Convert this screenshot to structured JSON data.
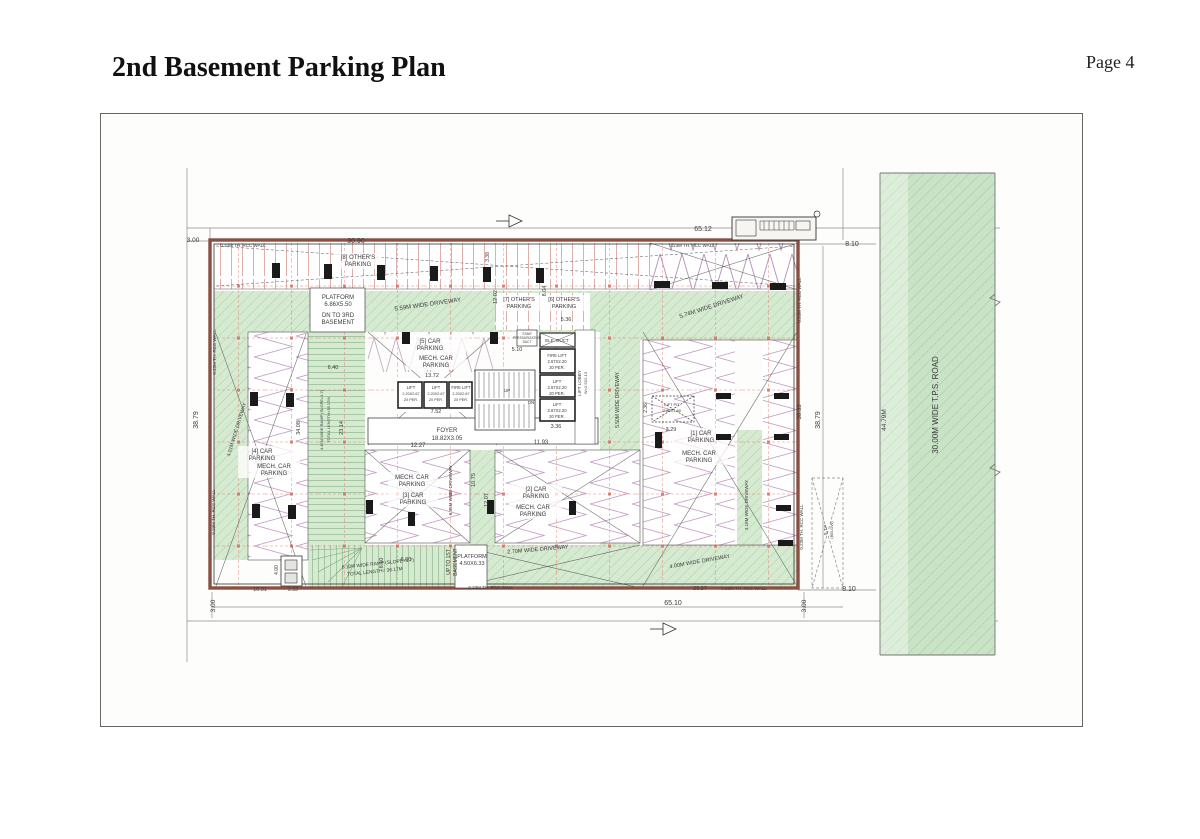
{
  "page": {
    "title": "2nd Basement Parking Plan",
    "page_number": "Page 4"
  },
  "plan": {
    "colors": {
      "wall": "#8a4f43",
      "green": "#d5ead1",
      "road_green": "#c9e3c6",
      "grid_red": "#e0796a",
      "zigzag": "#b48fb5",
      "stall_line": "#d89b93",
      "text": "#3b3b3b"
    },
    "labels": [
      {
        "t": "65.12",
        "x": 703,
        "y": 231,
        "s": 7
      },
      {
        "t": "30.90",
        "x": 356,
        "y": 243,
        "s": 7
      },
      {
        "t": "3.00",
        "x": 193,
        "y": 242,
        "s": 6.5
      },
      {
        "t": "8.10",
        "x": 852,
        "y": 246,
        "s": 7
      },
      {
        "t": "8.10",
        "x": 849,
        "y": 591,
        "s": 7
      },
      {
        "t": "65.10",
        "x": 673,
        "y": 605,
        "s": 7
      },
      {
        "t": "3.00",
        "x": 215,
        "y": 606,
        "s": 6.5,
        "r": -90
      },
      {
        "t": "3.00",
        "x": 806,
        "y": 606,
        "s": 6.5,
        "r": -90
      },
      {
        "t": "38.79",
        "x": 198,
        "y": 420,
        "s": 7,
        "r": -90
      },
      {
        "t": "38.79",
        "x": 820,
        "y": 420,
        "s": 7,
        "r": -90
      },
      {
        "t": "38.33",
        "x": 801,
        "y": 412,
        "s": 6,
        "r": -90
      },
      {
        "t": "44.79M",
        "x": 886,
        "y": 420,
        "s": 6.5,
        "r": -90
      },
      {
        "t": "30.00M WIDE T.P.S. ROAD",
        "x": 938,
        "y": 405,
        "s": 8,
        "r": -90
      },
      {
        "t": "0.23M TH. RCC WALL",
        "x": 243,
        "y": 247,
        "s": 4.5
      },
      {
        "t": "0.23M TH. RCC WALL",
        "x": 692,
        "y": 247,
        "s": 4.5
      },
      {
        "t": "0.23M TH. RCC WALL",
        "x": 216,
        "y": 352,
        "s": 4.5,
        "r": -90
      },
      {
        "t": "0.23M TH. RCC WALL",
        "x": 215,
        "y": 512,
        "s": 4.5,
        "r": -90
      },
      {
        "t": "0.23M TH. RCC WALL",
        "x": 801,
        "y": 300,
        "s": 4.5,
        "r": -90
      },
      {
        "t": "0.23M TH. RCC WALL",
        "x": 803,
        "y": 527,
        "s": 4.5,
        "r": -90
      },
      {
        "t": "0.23M TH. RCC WALL",
        "x": 491,
        "y": 589,
        "s": 4.5
      },
      {
        "t": "0.23M TH. RCC WALL",
        "x": 744,
        "y": 590,
        "s": 4.5
      },
      {
        "t": "[8] OTHER'S",
        "x": 358,
        "y": 259,
        "s": 6
      },
      {
        "t": "PARKING",
        "x": 358,
        "y": 266,
        "s": 6
      },
      {
        "t": "3.38",
        "x": 489,
        "y": 257,
        "s": 5,
        "r": -90
      },
      {
        "t": "12.02",
        "x": 497,
        "y": 297,
        "s": 5.5,
        "r": -90
      },
      {
        "t": "8.04",
        "x": 546,
        "y": 291,
        "s": 5.5,
        "r": -90
      },
      {
        "t": "PLATFORM",
        "x": 338,
        "y": 299,
        "s": 6
      },
      {
        "t": "6.86X5.50",
        "x": 338,
        "y": 306,
        "s": 6
      },
      {
        "t": "DN TO 3RD",
        "x": 338,
        "y": 317,
        "s": 6
      },
      {
        "t": "BASEMENT",
        "x": 338,
        "y": 324,
        "s": 6
      },
      {
        "t": "5.59M WIDE DRIVEWAY",
        "x": 428,
        "y": 306,
        "s": 6,
        "r": -8
      },
      {
        "t": "5.74M WIDE DRIVEWAY",
        "x": 712,
        "y": 308,
        "s": 6,
        "r": -18
      },
      {
        "t": "4.01M WIDE DRIVEWAY",
        "x": 238,
        "y": 430,
        "s": 5,
        "r": -73
      },
      {
        "t": "[7] OTHER'S",
        "x": 519,
        "y": 301,
        "s": 5.5
      },
      {
        "t": "PARKING",
        "x": 519,
        "y": 308,
        "s": 5.5
      },
      {
        "t": "[6] OTHER'S",
        "x": 564,
        "y": 301,
        "s": 5.5
      },
      {
        "t": "PARKING",
        "x": 564,
        "y": 308,
        "s": 5.5
      },
      {
        "t": "5.36",
        "x": 566,
        "y": 321,
        "s": 5.5
      },
      {
        "t": "STAIR",
        "x": 527,
        "y": 335,
        "s": 3.2
      },
      {
        "t": "PRESSURIZATION",
        "x": 527,
        "y": 339,
        "s": 3.2
      },
      {
        "t": "DUCT",
        "x": 527,
        "y": 343,
        "s": 3.2
      },
      {
        "t": "ELE. DUCT",
        "x": 557,
        "y": 342,
        "s": 4.5
      },
      {
        "t": "5.10",
        "x": 517,
        "y": 351,
        "s": 5.5
      },
      {
        "t": "[5] CAR",
        "x": 430,
        "y": 343,
        "s": 6
      },
      {
        "t": "PARKING",
        "x": 430,
        "y": 350,
        "s": 6
      },
      {
        "t": "MECH. CAR",
        "x": 436,
        "y": 360,
        "s": 6
      },
      {
        "t": "PARKING",
        "x": 436,
        "y": 367,
        "s": 6
      },
      {
        "t": "6.40",
        "x": 333,
        "y": 369,
        "s": 5.5
      },
      {
        "t": "13.72",
        "x": 432,
        "y": 377,
        "s": 5.5
      },
      {
        "t": "FIRE LIFT",
        "x": 557,
        "y": 357,
        "s": 4.2
      },
      {
        "t": "2.67X2.20",
        "x": 557,
        "y": 363,
        "s": 4.2
      },
      {
        "t": "20 PER.",
        "x": 557,
        "y": 369,
        "s": 4.2
      },
      {
        "t": "LIFT",
        "x": 557,
        "y": 383,
        "s": 4.2
      },
      {
        "t": "2.67X2.20",
        "x": 557,
        "y": 389,
        "s": 4.2
      },
      {
        "t": "20 PER.",
        "x": 557,
        "y": 395,
        "s": 4.2
      },
      {
        "t": "LIFT",
        "x": 557,
        "y": 406,
        "s": 4.2
      },
      {
        "t": "2.67X2.20",
        "x": 557,
        "y": 412,
        "s": 4.2
      },
      {
        "t": "20 PER.",
        "x": 557,
        "y": 418,
        "s": 4.2
      },
      {
        "t": "LIFT LOBBY",
        "x": 581,
        "y": 383,
        "s": 4.5,
        "r": -90
      },
      {
        "t": "W=2.5X2.13",
        "x": 587,
        "y": 383,
        "s": 4,
        "r": -90
      },
      {
        "t": "3.36",
        "x": 556,
        "y": 428,
        "s": 5.5
      },
      {
        "t": "LIFT",
        "x": 411,
        "y": 389,
        "s": 4.2
      },
      {
        "t": "2.20X2.67",
        "x": 411,
        "y": 395,
        "s": 3.8
      },
      {
        "t": "20 PER.",
        "x": 411,
        "y": 401,
        "s": 3.8
      },
      {
        "t": "LIFT",
        "x": 436,
        "y": 389,
        "s": 4.2
      },
      {
        "t": "2.20X2.67",
        "x": 436,
        "y": 395,
        "s": 3.8
      },
      {
        "t": "20 PER.",
        "x": 436,
        "y": 401,
        "s": 3.8
      },
      {
        "t": "FIRE LIFT",
        "x": 461,
        "y": 389,
        "s": 4.2
      },
      {
        "t": "2.20X2.67",
        "x": 461,
        "y": 395,
        "s": 3.8
      },
      {
        "t": "20 PER.",
        "x": 461,
        "y": 401,
        "s": 3.8
      },
      {
        "t": "7.52",
        "x": 436,
        "y": 413,
        "s": 5.5
      },
      {
        "t": "UP",
        "x": 507,
        "y": 392,
        "s": 4.5
      },
      {
        "t": "DN",
        "x": 531,
        "y": 404,
        "s": 4.5
      },
      {
        "t": "FOYER",
        "x": 447,
        "y": 432,
        "s": 6
      },
      {
        "t": "18.82X3.05",
        "x": 447,
        "y": 440,
        "s": 6
      },
      {
        "t": "12.27",
        "x": 418,
        "y": 447,
        "s": 6
      },
      {
        "t": "11.93",
        "x": 541,
        "y": 444,
        "s": 6
      },
      {
        "t": "34.08",
        "x": 300,
        "y": 428,
        "s": 5.5,
        "r": -90
      },
      {
        "t": "4.49M WIDE RAMP (SLOPE=1:7)",
        "x": 323,
        "y": 420,
        "s": 4,
        "r": -90
      },
      {
        "t": "TOTAL LENGTH=35.17M",
        "x": 330,
        "y": 420,
        "s": 4,
        "r": -90
      },
      {
        "t": "23.14",
        "x": 343,
        "y": 428,
        "s": 5.5,
        "r": -90
      },
      {
        "t": "[4] CAR",
        "x": 262,
        "y": 453,
        "s": 6
      },
      {
        "t": "PARKING",
        "x": 262,
        "y": 460,
        "s": 6
      },
      {
        "t": "MECH. CAR",
        "x": 274,
        "y": 468,
        "s": 6
      },
      {
        "t": "PARKING",
        "x": 274,
        "y": 475,
        "s": 6
      },
      {
        "t": "MECH. CAR",
        "x": 412,
        "y": 479,
        "s": 6
      },
      {
        "t": "PARKING",
        "x": 412,
        "y": 486,
        "s": 6
      },
      {
        "t": "[3] CAR",
        "x": 413,
        "y": 497,
        "s": 6
      },
      {
        "t": "PARKING",
        "x": 413,
        "y": 504,
        "s": 6
      },
      {
        "t": "6.35M WIDE DRIVEWAY",
        "x": 452,
        "y": 490,
        "s": 4.5,
        "r": -90
      },
      {
        "t": "10.75",
        "x": 475,
        "y": 480,
        "s": 5.5,
        "r": -90
      },
      {
        "t": "12.07",
        "x": 488,
        "y": 500,
        "s": 5.5,
        "r": -90
      },
      {
        "t": "[2] CAR",
        "x": 536,
        "y": 491,
        "s": 6
      },
      {
        "t": "PARKING",
        "x": 536,
        "y": 498,
        "s": 6
      },
      {
        "t": "MECH. CAR",
        "x": 533,
        "y": 509,
        "s": 6
      },
      {
        "t": "PARKING",
        "x": 533,
        "y": 516,
        "s": 6
      },
      {
        "t": "5.50M WIDE DRIVEWAY",
        "x": 619,
        "y": 400,
        "s": 5,
        "r": -90
      },
      {
        "t": "2.70M WIDE DRIVEWAY",
        "x": 538,
        "y": 551,
        "s": 5.5,
        "r": -5
      },
      {
        "t": "4.00M WIDE DRIVEWAY",
        "x": 700,
        "y": 563,
        "s": 5.5,
        "r": -10
      },
      {
        "t": "UP TO 1ST",
        "x": 450,
        "y": 562,
        "s": 5,
        "r": -90
      },
      {
        "t": "BASEMENT",
        "x": 457,
        "y": 562,
        "s": 5,
        "r": -90
      },
      {
        "t": "PLATFORM",
        "x": 472,
        "y": 558,
        "s": 5.5
      },
      {
        "t": "4.50X6.33",
        "x": 472,
        "y": 565,
        "s": 5.5
      },
      {
        "t": "6.10",
        "x": 383,
        "y": 563,
        "s": 5.5,
        "r": -90
      },
      {
        "t": "6.00",
        "x": 406,
        "y": 561,
        "s": 5.5
      },
      {
        "t": "6.10M WIDE RAMP (SLOPE=1:7)",
        "x": 378,
        "y": 565,
        "s": 4.8,
        "r": -6
      },
      {
        "t": "TOTAL LENGTH= 36.17M",
        "x": 375,
        "y": 573,
        "s": 4.8,
        "r": -6
      },
      {
        "t": "10.31",
        "x": 260,
        "y": 591,
        "s": 5.5
      },
      {
        "t": "2.33",
        "x": 293,
        "y": 591,
        "s": 5
      },
      {
        "t": "4.00",
        "x": 278,
        "y": 570,
        "s": 5,
        "r": -90
      },
      {
        "t": "23.27",
        "x": 700,
        "y": 590,
        "s": 5.5
      },
      {
        "t": "LIFT PIT",
        "x": 672,
        "y": 406,
        "s": 4
      },
      {
        "t": "2.80X1.80",
        "x": 672,
        "y": 412,
        "s": 4
      },
      {
        "t": "2.36",
        "x": 647,
        "y": 408,
        "s": 5,
        "r": -90
      },
      {
        "t": "3.29",
        "x": 671,
        "y": 431,
        "s": 5.5
      },
      {
        "t": "[1] CAR",
        "x": 701,
        "y": 435,
        "s": 6
      },
      {
        "t": "PARKING",
        "x": 701,
        "y": 442,
        "s": 6
      },
      {
        "t": "MECH. CAR",
        "x": 699,
        "y": 455,
        "s": 6
      },
      {
        "t": "PARKING",
        "x": 699,
        "y": 462,
        "s": 6
      },
      {
        "t": "3.16M WIDE DRIVEWAY",
        "x": 748,
        "y": 505,
        "s": 4.5,
        "r": -90
      },
      {
        "t": "S.T.P",
        "x": 827,
        "y": 530,
        "s": 4.5,
        "r": -90
      },
      {
        "t": "(BELOW)",
        "x": 833,
        "y": 530,
        "s": 4,
        "r": -90
      }
    ]
  }
}
